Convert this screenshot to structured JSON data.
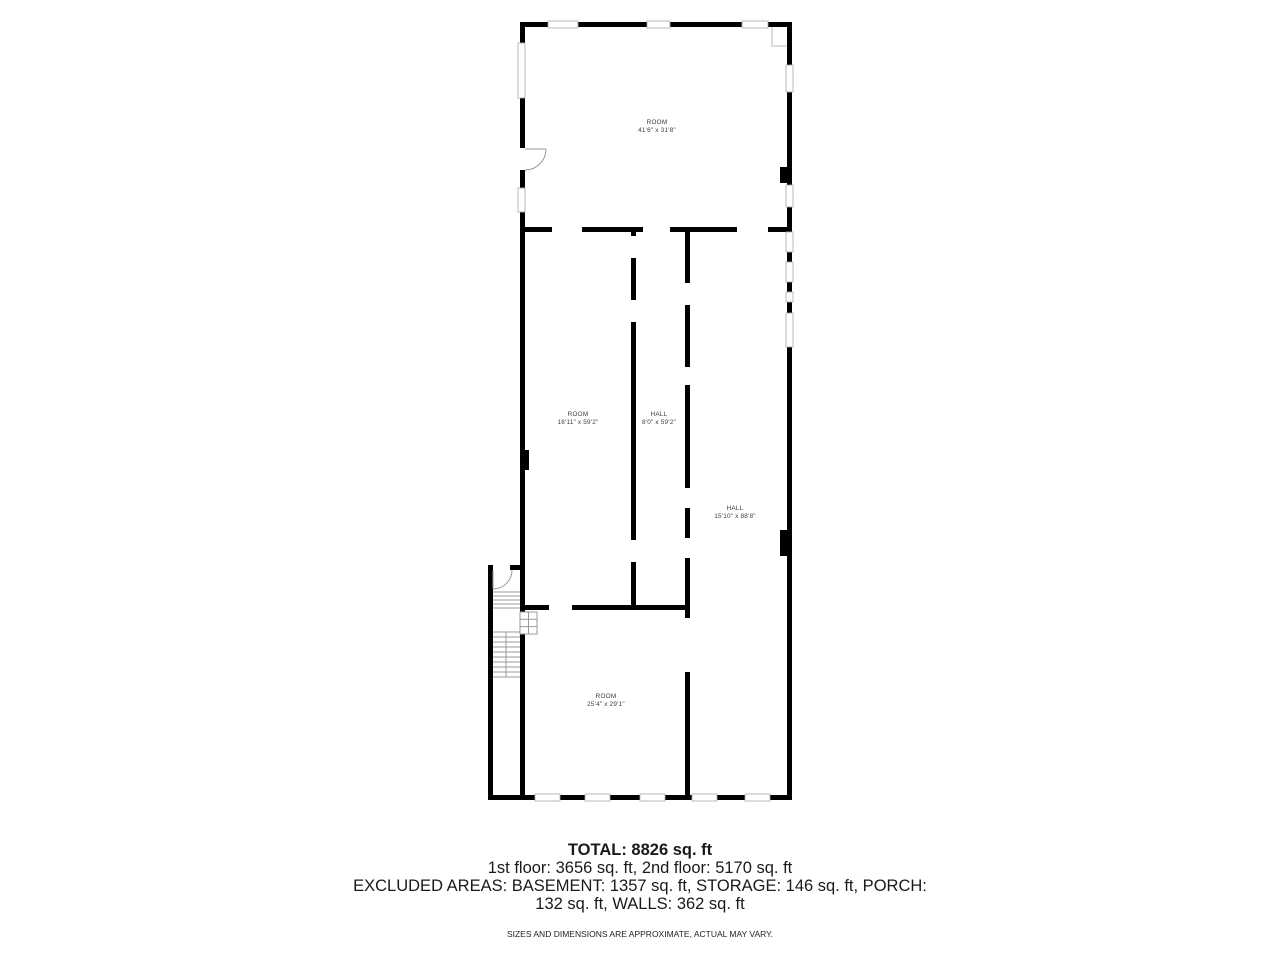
{
  "floor_plan": {
    "wall_color": "#000000",
    "window_color": "#ffffff",
    "detail_color": "#999999",
    "rooms": [
      {
        "id": "room-top",
        "name": "ROOM",
        "dimensions": "41'6\" x 31'8\""
      },
      {
        "id": "room-middle",
        "name": "ROOM",
        "dimensions": "16'11\" x 59'2\""
      },
      {
        "id": "hall-middle",
        "name": "HALL",
        "dimensions": "8'0\" x 59'2\""
      },
      {
        "id": "hall-right",
        "name": "HALL",
        "dimensions": "15'10\" x 88'8\""
      },
      {
        "id": "room-bottom",
        "name": "ROOM",
        "dimensions": "25'4\" x 29'1\""
      }
    ]
  },
  "summary": {
    "total": "TOTAL: 8826 sq. ft",
    "floors": "1st floor: 3656 sq. ft, 2nd floor: 5170 sq. ft",
    "excluded": "EXCLUDED AREAS: BASEMENT: 1357 sq. ft, STORAGE: 146 sq. ft, PORCH: 132 sq. ft, WALLS: 362 sq. ft",
    "disclaimer": "SIZES AND DIMENSIONS ARE APPROXIMATE, ACTUAL MAY VARY."
  }
}
